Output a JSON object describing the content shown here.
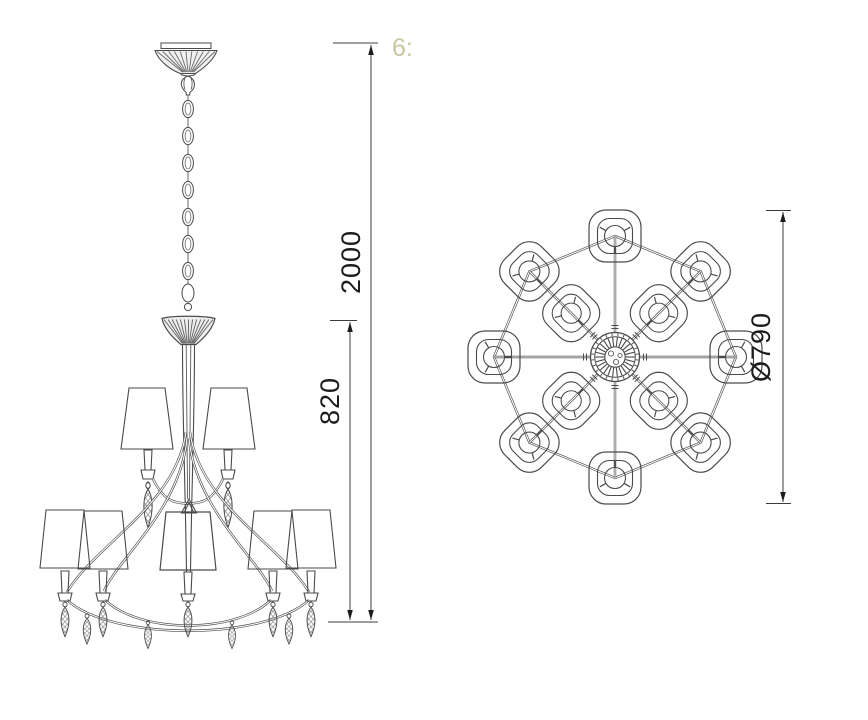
{
  "watermark": {
    "text": "6:"
  },
  "side_view": {
    "total_height_label": "2000",
    "body_height_label": "820"
  },
  "plan_view": {
    "diameter_label": "Ø790"
  },
  "drawing": {
    "outer_shade_count": 8,
    "inner_shade_count": 4
  },
  "colors": {
    "line": "#4a4a4a",
    "dimension": "#1c1c1c",
    "watermark": "#b9ba85",
    "background": "#ffffff"
  }
}
